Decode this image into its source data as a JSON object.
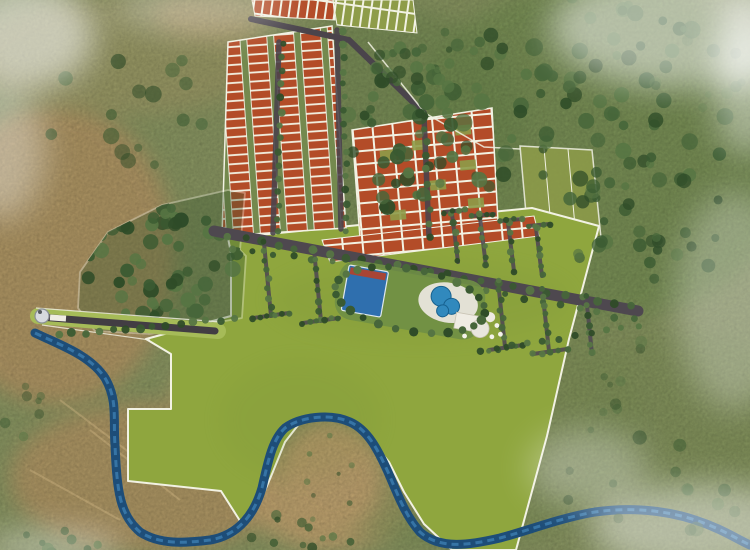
{
  "palette": {
    "terrain": "#8f9c66",
    "tan1": "#bb9c69",
    "tan2": "#c9aa74",
    "tan3": "#b0a26d",
    "grn1": "#7a9456",
    "grn2": "#84975c",
    "grn3": "#6e8a50",
    "lawn_green": "#8fa63e",
    "boundary_white": "#f2f2e3",
    "plot_orange": "#b34c28",
    "plot_olive": "#8e9c49",
    "gap_green": "#74894e",
    "road_dark": "#4e484f",
    "entrance_road": "#423d43",
    "verge_green": "#a6bb58",
    "river_deep": "#1d4d78",
    "river_light": "#3f82b4",
    "court_blue": "#2f6fae",
    "pool_blue": "#3189bd",
    "deck_white": "#e9e6dd",
    "building_white": "#efece3",
    "gate_gray": "#d6dadd",
    "tree_colors": [
      "#3a5a31",
      "#2f4c28",
      "#47663a",
      "#567543"
    ],
    "haze_white": "#ffffff",
    "path_tan": "#d8bd8a"
  },
  "scene": {
    "patches": [
      [
        55,
        255,
        120,
        150,
        "tan1",
        0.9
      ],
      [
        150,
        478,
        140,
        75,
        "tan1",
        0.85
      ],
      [
        330,
        495,
        85,
        55,
        "tan2",
        0.9
      ],
      [
        120,
        55,
        150,
        60,
        "tan3",
        0.5
      ],
      [
        215,
        15,
        60,
        25,
        "tan2",
        0.5
      ],
      [
        600,
        150,
        200,
        170,
        "grn1",
        0.8
      ],
      [
        450,
        420,
        190,
        130,
        "grn2",
        0.6
      ],
      [
        395,
        120,
        130,
        110,
        "grn3",
        0.5
      ],
      [
        680,
        420,
        120,
        90,
        "grn2",
        0.5
      ],
      [
        240,
        395,
        70,
        45,
        "tan2",
        0.55
      ],
      [
        330,
        478,
        52,
        58,
        "tan2",
        0.95
      ]
    ],
    "tree_clusters": [
      {
        "cx": 585,
        "cy": 110,
        "rx": 150,
        "ry": 115,
        "n": 85,
        "rmin": 4,
        "rmax": 9,
        "op": 0.92
      },
      {
        "cx": 655,
        "cy": 225,
        "rx": 95,
        "ry": 55,
        "n": 26,
        "rmin": 4,
        "rmax": 8,
        "op": 0.85
      },
      {
        "cx": 398,
        "cy": 130,
        "rx": 58,
        "ry": 88,
        "n": 48,
        "rmin": 4,
        "rmax": 8,
        "op": 0.95
      },
      {
        "cx": 425,
        "cy": 55,
        "rx": 55,
        "ry": 38,
        "n": 16,
        "rmin": 3,
        "rmax": 7,
        "op": 0.8
      },
      {
        "cx": 162,
        "cy": 262,
        "rx": 80,
        "ry": 62,
        "n": 58,
        "rmin": 4,
        "rmax": 8,
        "op": 1,
        "clip": true
      },
      {
        "cx": 120,
        "cy": 95,
        "rx": 95,
        "ry": 75,
        "n": 16,
        "rmin": 4,
        "rmax": 9,
        "op": 0.65
      },
      {
        "cx": 655,
        "cy": 485,
        "rx": 95,
        "ry": 50,
        "n": 14,
        "rmin": 4,
        "rmax": 8,
        "op": 0.55
      },
      {
        "cx": 300,
        "cy": 530,
        "rx": 75,
        "ry": 18,
        "n": 11,
        "rmin": 3,
        "rmax": 6,
        "op": 0.8
      },
      {
        "cx": 700,
        "cy": 65,
        "rx": 55,
        "ry": 48,
        "n": 10,
        "rmin": 3,
        "rmax": 6,
        "op": 0.5
      },
      {
        "cx": 615,
        "cy": 385,
        "rx": 45,
        "ry": 60,
        "n": 9,
        "rmin": 3,
        "rmax": 6,
        "op": 0.45
      },
      {
        "cx": 45,
        "cy": 542,
        "rx": 60,
        "ry": 14,
        "n": 9,
        "rmin": 3,
        "rmax": 6,
        "op": 0.85
      },
      {
        "cx": 30,
        "cy": 420,
        "rx": 40,
        "ry": 40,
        "n": 7,
        "rmin": 3,
        "rmax": 6,
        "op": 0.5
      },
      {
        "cx": 330,
        "cy": 478,
        "rx": 45,
        "ry": 45,
        "n": 8,
        "rmin": 2,
        "rmax": 3.5,
        "op": 0.6
      }
    ],
    "tree_rows": [
      {
        "pts": [
          [
            228,
            236
          ],
          [
            430,
            272
          ],
          [
            632,
            306
          ]
        ],
        "sp": 16,
        "r": 4
      },
      {
        "pts": [
          [
            234,
            248
          ],
          [
            332,
            262
          ]
        ],
        "sp": 17,
        "r": 3.5
      },
      {
        "pts": [
          [
            487,
            291
          ],
          [
            634,
            320
          ]
        ],
        "sp": 17,
        "r": 3.5
      },
      {
        "pts": [
          [
            58,
            335
          ],
          [
            234,
            319
          ]
        ],
        "sp": 13,
        "r": 4
      },
      {
        "pts": [
          [
            452,
            214
          ],
          [
            458,
            262
          ]
        ],
        "sp": 9,
        "r": 3.2
      },
      {
        "pts": [
          [
            480,
            218
          ],
          [
            486,
            266
          ]
        ],
        "sp": 9,
        "r": 3.2
      },
      {
        "pts": [
          [
            508,
            223
          ],
          [
            514,
            271
          ]
        ],
        "sp": 9,
        "r": 3.2
      },
      {
        "pts": [
          [
            536,
            228
          ],
          [
            542,
            276
          ]
        ],
        "sp": 9,
        "r": 3.2
      },
      {
        "pts": [
          [
            444,
            212
          ],
          [
            466,
            210
          ]
        ],
        "sp": 7,
        "r": 3
      },
      {
        "pts": [
          [
            472,
            216
          ],
          [
            494,
            214
          ]
        ],
        "sp": 7,
        "r": 3
      },
      {
        "pts": [
          [
            500,
            221
          ],
          [
            522,
            219
          ]
        ],
        "sp": 7,
        "r": 3
      },
      {
        "pts": [
          [
            528,
            226
          ],
          [
            550,
            224
          ]
        ],
        "sp": 7,
        "r": 3
      },
      {
        "pts": [
          [
            264,
            243
          ],
          [
            271,
            316
          ]
        ],
        "sp": 9,
        "r": 3.2
      },
      {
        "pts": [
          [
            253,
            318
          ],
          [
            289,
            313
          ]
        ],
        "sp": 7,
        "r": 3
      },
      {
        "pts": [
          [
            314,
            250
          ],
          [
            321,
            321
          ]
        ],
        "sp": 9,
        "r": 3.2
      },
      {
        "pts": [
          [
            303,
            323
          ],
          [
            339,
            318
          ]
        ],
        "sp": 7,
        "r": 3
      },
      {
        "pts": [
          [
            498,
            281
          ],
          [
            505,
            347
          ]
        ],
        "sp": 9,
        "r": 3.2
      },
      {
        "pts": [
          [
            489,
            350
          ],
          [
            523,
            345
          ]
        ],
        "sp": 7,
        "r": 3
      },
      {
        "pts": [
          [
            542,
            288
          ],
          [
            549,
            351
          ]
        ],
        "sp": 9,
        "r": 3.2
      },
      {
        "pts": [
          [
            533,
            354
          ],
          [
            567,
            349
          ]
        ],
        "sp": 7,
        "r": 3
      },
      {
        "pts": [
          [
            586,
            295
          ],
          [
            592,
            354
          ]
        ],
        "sp": 9,
        "r": 3.2
      },
      {
        "pts": [
          [
            480,
            352
          ],
          [
            638,
            326
          ]
        ],
        "sp": 15,
        "r": 3.5
      },
      {
        "pts": [
          [
            283,
            45
          ],
          [
            277,
            232
          ]
        ],
        "sp": 13,
        "r": 3.5
      },
      {
        "pts": [
          [
            343,
            32
          ],
          [
            347,
            230
          ]
        ],
        "sp": 13,
        "r": 3.5
      },
      {
        "pts": [
          [
            425,
            115
          ],
          [
            430,
            237
          ]
        ],
        "sp": 13,
        "r": 3.5
      }
    ],
    "amenity_ring": {
      "cx": 410,
      "cy": 300,
      "rx": 76,
      "ry": 31,
      "rot": 10,
      "n": 26,
      "r": 4.2
    },
    "haze": [
      [
        25,
        35,
        70,
        55,
        0.55
      ],
      [
        680,
        28,
        130,
        60,
        0.5
      ],
      [
        748,
        95,
        35,
        60,
        0.4
      ],
      [
        700,
        528,
        110,
        45,
        0.45
      ],
      [
        588,
        468,
        60,
        40,
        0.3
      ],
      [
        0,
        150,
        45,
        70,
        0.35
      ],
      [
        52,
        548,
        70,
        18,
        0.4
      ],
      [
        735,
        300,
        60,
        110,
        0.28
      ],
      [
        200,
        8,
        90,
        25,
        0.3
      ],
      [
        745,
        42,
        28,
        48,
        0.5
      ]
    ],
    "dirt_paths": [
      [
        [
          60,
          400
        ],
        [
          150,
          468
        ]
      ],
      [
        [
          90,
          430
        ],
        [
          180,
          500
        ]
      ],
      [
        [
          30,
          470
        ],
        [
          120,
          520
        ]
      ]
    ]
  }
}
